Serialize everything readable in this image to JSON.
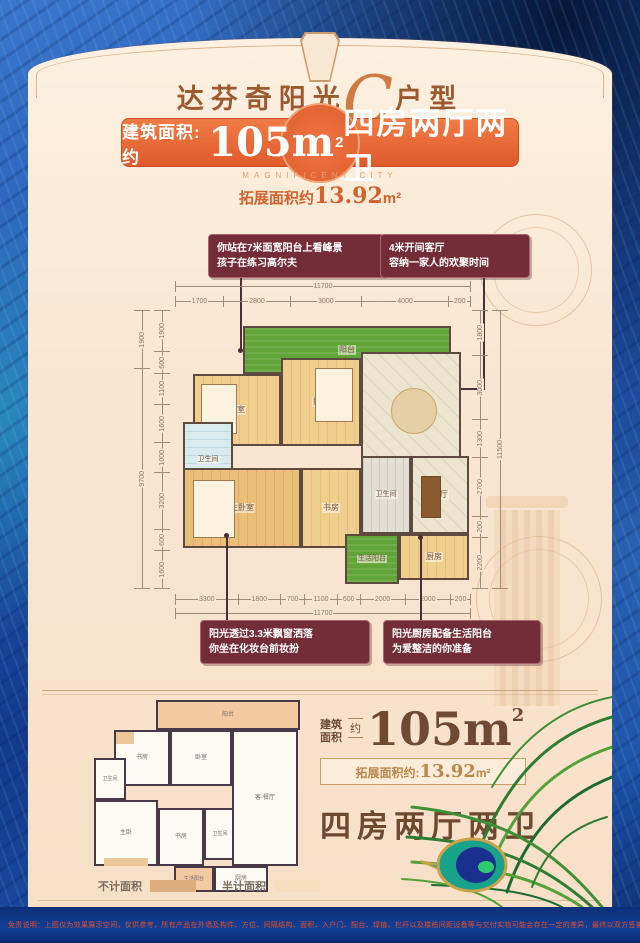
{
  "header": {
    "title_left": "达芬奇阳光",
    "title_script": "C",
    "title_right": "户型",
    "banner_label": "建筑面积:约",
    "banner_value": "105m",
    "banner_sup": "2",
    "banner_rooms": "四房两厅两卫",
    "caption_en": "MAGNIFICENT CITY",
    "expand_prefix": "拓展面积约",
    "expand_number": "13.92",
    "expand_unit": "m²"
  },
  "callouts": {
    "top_left_line1": "你站在7米面宽阳台上看峰景",
    "top_left_line2": "孩子在练习高尔夫",
    "top_right_line1": "4米开间客厅",
    "top_right_line2": "容纳一家人的欢聚时间",
    "bottom_left_line1": "阳光透过3.3米飘窗洒落",
    "bottom_left_line2": "你坐在化妆台前妆扮",
    "bottom_right_line1": "阳光厨房配备生活阳台",
    "bottom_right_line2": "为爱整洁的你准备"
  },
  "floorplan": {
    "rooms": {
      "balcony": "阳台",
      "bedroom1": "卧室",
      "bedroom2": "卧室",
      "living": "客厅",
      "bath1": "卫生间",
      "master": "主卧室",
      "study": "书房",
      "bath2": "卫生间",
      "dining": "餐厅",
      "life_balcony": "生活阳台",
      "kitchen": "厨房"
    },
    "dims": {
      "top_overall": "11700",
      "top": [
        "1700",
        "2800",
        "3000",
        "4000",
        "200"
      ],
      "bottom": [
        "3300",
        "1800",
        "700",
        "1100",
        "600",
        "2000",
        "2000",
        "200"
      ],
      "bottom_overall": "11700",
      "left_outer": [
        "1900",
        "9700"
      ],
      "left": [
        "1900",
        "600",
        "1100",
        "1600",
        "1000",
        "3200",
        "600",
        "1600"
      ],
      "right": [
        "1800",
        "3000",
        "1300",
        "2700",
        "200",
        "2200"
      ],
      "right_overall": "11500"
    }
  },
  "mini_plan": {
    "rooms": {
      "balcony": "阳台",
      "study1": "书房",
      "bedroom": "卧室",
      "bath1": "卫生间",
      "master": "主卧",
      "study2": "书房",
      "bath2": "卫生间",
      "living_dining": "客·餐厅",
      "life_balcony": "生活阳台",
      "kitchen": "厨房"
    }
  },
  "summary": {
    "stack_line1": "建筑",
    "stack_line2": "面积",
    "approx": "约",
    "area_value": "105m",
    "area_sup": "2",
    "expand_prefix": "拓展面积约:",
    "expand_number": "13.92",
    "expand_unit": "m²",
    "rooms_text": "四房两厅两卫"
  },
  "legend": {
    "no_area": "不计面积",
    "half_area": "半计面积"
  },
  "disclaimer": "免责说明：上图仅为效果展示空间，仅供参考，所有产品在外墙及构件、方位、间隔结构、面积、入户门、配台、绿植、栏杆以及楼栋间距设备等与交付实物可能会存在一定的差异，最终以双方签署的买卖合同、政府相关文件及交付验收的实物为准。",
  "colors": {
    "banner_orange": "#e05a2b",
    "card_cream": "#f9e6d2",
    "background_blue": "#2257ae",
    "callout_maroon": "#732d36",
    "balcony_green": "#61a437",
    "brand_brown": "#6e4a32"
  }
}
